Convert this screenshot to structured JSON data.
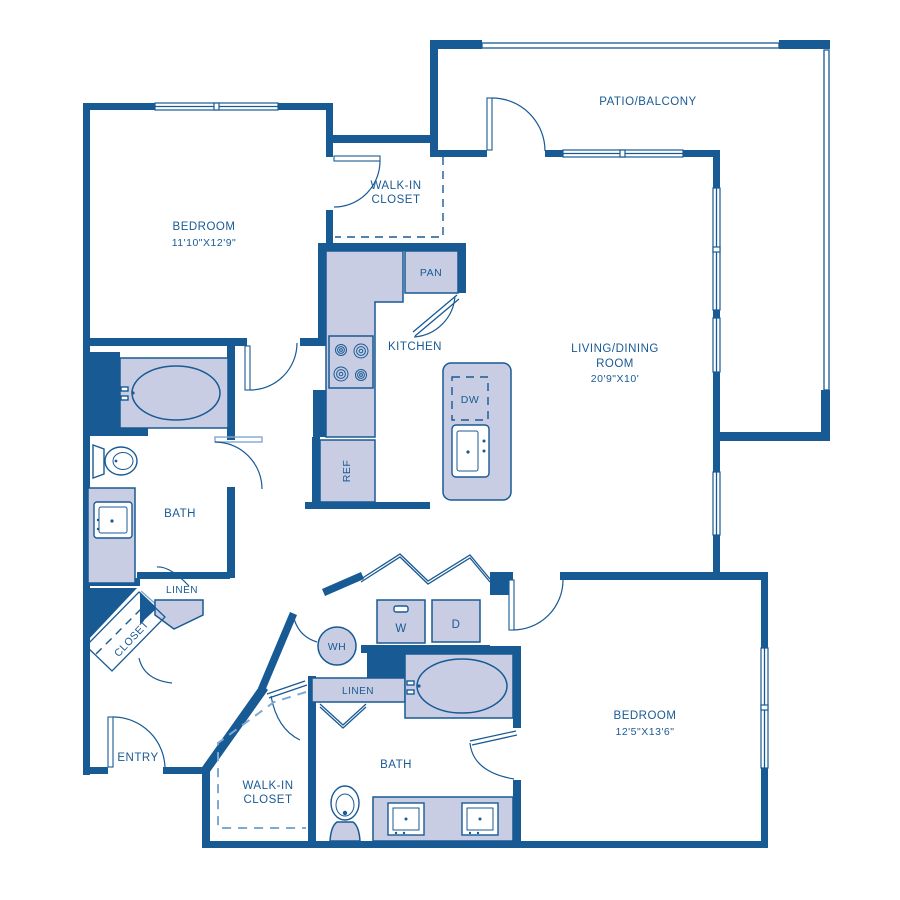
{
  "rooms": {
    "patio_balcony": {
      "label": "PATIO/BALCONY"
    },
    "bedroom_1": {
      "label": "BEDROOM",
      "dimensions": "11'10\"X12'9\""
    },
    "walk_in_closet_1": {
      "line1": "WALK-IN",
      "line2": "CLOSET"
    },
    "kitchen": {
      "label": "KITCHEN"
    },
    "living_dining": {
      "line1": "LIVING/DINING",
      "line2": "ROOM",
      "dimensions": "20'9\"X10'"
    },
    "bath_1": {
      "label": "BATH"
    },
    "linen_1": {
      "label": "LINEN"
    },
    "closet_1": {
      "label": "CLOSET"
    },
    "entry": {
      "label": "ENTRY"
    },
    "walk_in_closet_2": {
      "line1": "WALK-IN",
      "line2": "CLOSET"
    },
    "bath_2": {
      "label": "BATH"
    },
    "linen_2": {
      "label": "LINEN"
    },
    "bedroom_2": {
      "label": "BEDROOM",
      "dimensions": "12'5\"X13'6\""
    }
  },
  "appliances": {
    "pantry": "PAN",
    "refrigerator": "REF",
    "dishwasher": "DW",
    "washer": "W",
    "dryer": "D",
    "water_heater": "WH"
  },
  "colors": {
    "wall": "#185a94",
    "fixture_fill": "#c8cde4",
    "light_line": "#7fa9d2",
    "background": "#ffffff"
  }
}
